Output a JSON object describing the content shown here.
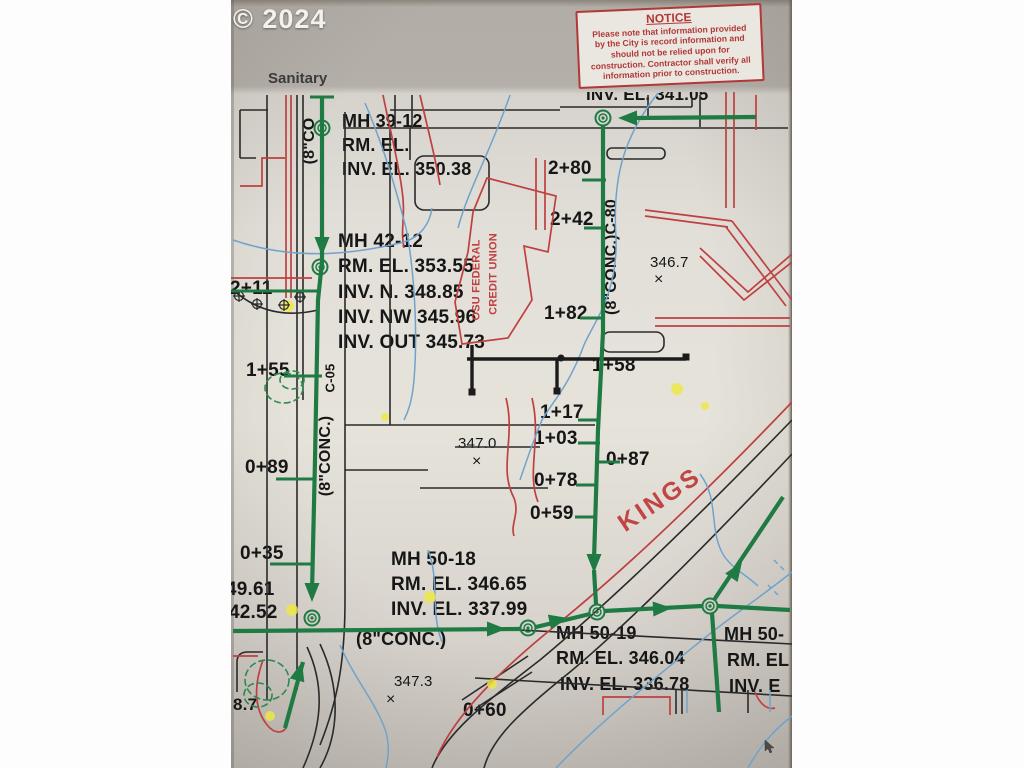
{
  "palette": {
    "sewer_green": "#1f7a43",
    "utility_red": "#bf4040",
    "contour_blue": "#6fa3cc",
    "ink_black": "#222222",
    "highlight_yellow": "#eee93f",
    "notice_red": "#b23737",
    "paper": "#ddd9d2"
  },
  "watermark": {
    "text": "© 2024"
  },
  "photo": {
    "band_label": "Sanitary"
  },
  "notice": {
    "title": "NOTICE",
    "lines": [
      "Please note that information provided",
      "by the City is record information and",
      "should not be relied upon for",
      "construction. Contractor shall verify all",
      "information prior to construction."
    ]
  },
  "map_labels": [
    {
      "name": "inv-el-341",
      "text": "INV. EL. 341.05",
      "x": 586,
      "y": 86,
      "fs": 17
    },
    {
      "name": "mh-39-12-line1",
      "text": "MH 39-12",
      "x": 342,
      "y": 112,
      "fs": 18
    },
    {
      "name": "mh-39-12-line2",
      "text": "RM. EL.",
      "x": 342,
      "y": 136,
      "fs": 18
    },
    {
      "name": "mh-39-12-line3",
      "text": "INV. EL. 350.38",
      "x": 342,
      "y": 160,
      "fs": 18
    },
    {
      "name": "station-2-80",
      "text": "2+80",
      "x": 548,
      "y": 159,
      "fs": 19
    },
    {
      "name": "station-2-42",
      "text": "2+42",
      "x": 550,
      "y": 210,
      "fs": 19
    },
    {
      "name": "pipe-label-c80",
      "text": "(8\"CONC.)C-80",
      "x": 612,
      "y": 257,
      "fs": 16,
      "rot": -90,
      "anchor": "c"
    },
    {
      "name": "spot-elev-346-7",
      "text": "346.7",
      "x": 650,
      "y": 255,
      "fs": 15,
      "w": 400
    },
    {
      "name": "spot-elev-346-7-x",
      "text": "×",
      "x": 654,
      "y": 272,
      "fs": 16,
      "w": 400
    },
    {
      "name": "mh-42-12-line1",
      "text": "MH 42-12",
      "x": 338,
      "y": 232,
      "fs": 19
    },
    {
      "name": "mh-42-12-line2",
      "text": "RM. EL. 353.55",
      "x": 338,
      "y": 257,
      "fs": 19
    },
    {
      "name": "mh-42-12-line3",
      "text": "INV. N. 348.85",
      "x": 338,
      "y": 283,
      "fs": 19
    },
    {
      "name": "mh-42-12-line4",
      "text": "INV. NW 345.96",
      "x": 338,
      "y": 308,
      "fs": 19
    },
    {
      "name": "mh-42-12-line5",
      "text": "INV. OUT 345.73",
      "x": 338,
      "y": 333,
      "fs": 19
    },
    {
      "name": "credit-union-line1",
      "text": "OSU FEDERAL",
      "x": 477,
      "y": 280,
      "fs": 11,
      "rot": -90,
      "anchor": "c",
      "color": "#bf4040"
    },
    {
      "name": "credit-union-line2",
      "text": "CREDIT UNION",
      "x": 494,
      "y": 274,
      "fs": 11,
      "rot": -90,
      "anchor": "c",
      "color": "#bf4040"
    },
    {
      "name": "station-2-11",
      "text": "2+11",
      "x": 230,
      "y": 279,
      "fs": 19
    },
    {
      "name": "station-1-82",
      "text": "1+82",
      "x": 544,
      "y": 304,
      "fs": 19
    },
    {
      "name": "station-1-55",
      "text": "1+55",
      "x": 246,
      "y": 361,
      "fs": 19
    },
    {
      "name": "station-1-58",
      "text": "1+58",
      "x": 592,
      "y": 356,
      "fs": 19
    },
    {
      "name": "pipe-label-8co",
      "text": "(8\"CO",
      "x": 310,
      "y": 141,
      "fs": 16,
      "rot": -90,
      "anchor": "c"
    },
    {
      "name": "pipe-label-c05",
      "text": "C-05",
      "x": 330,
      "y": 378,
      "fs": 13,
      "rot": -90,
      "anchor": "c"
    },
    {
      "name": "pipe-label-conc-left",
      "text": "(8\"CONC.)",
      "x": 326,
      "y": 456,
      "fs": 16,
      "rot": -90,
      "anchor": "c"
    },
    {
      "name": "spot-elev-347-0",
      "text": "347.0",
      "x": 458,
      "y": 436,
      "fs": 15,
      "w": 400
    },
    {
      "name": "spot-elev-347-0-x",
      "text": "×",
      "x": 472,
      "y": 454,
      "fs": 16,
      "w": 400
    },
    {
      "name": "station-1-17",
      "text": "1+17",
      "x": 540,
      "y": 403,
      "fs": 19
    },
    {
      "name": "station-1-03",
      "text": "1+03",
      "x": 534,
      "y": 429,
      "fs": 19
    },
    {
      "name": "station-0-87",
      "text": "0+87",
      "x": 606,
      "y": 450,
      "fs": 19
    },
    {
      "name": "station-0-78",
      "text": "0+78",
      "x": 534,
      "y": 471,
      "fs": 19
    },
    {
      "name": "station-0-59",
      "text": "0+59",
      "x": 530,
      "y": 504,
      "fs": 19
    },
    {
      "name": "street-name-kings",
      "text": "KINGS",
      "x": 660,
      "y": 500,
      "fs": 25,
      "rot": -34,
      "anchor": "c",
      "color": "#c24545",
      "ls": 3
    },
    {
      "name": "station-0-89",
      "text": "0+89",
      "x": 245,
      "y": 458,
      "fs": 19
    },
    {
      "name": "station-0-35",
      "text": "0+35",
      "x": 240,
      "y": 544,
      "fs": 19
    },
    {
      "name": "elev-49-61",
      "text": "49.61",
      "x": 226,
      "y": 580,
      "fs": 19
    },
    {
      "name": "elev-42-52",
      "text": "42.52",
      "x": 229,
      "y": 603,
      "fs": 19
    },
    {
      "name": "mh-50-18-line1",
      "text": "MH 50-18",
      "x": 391,
      "y": 550,
      "fs": 19
    },
    {
      "name": "mh-50-18-line2",
      "text": "RM. EL. 346.65",
      "x": 391,
      "y": 575,
      "fs": 19
    },
    {
      "name": "mh-50-18-line3",
      "text": "INV. EL. 337.99",
      "x": 391,
      "y": 600,
      "fs": 19
    },
    {
      "name": "pipe-label-conc-bottom",
      "text": "(8\"CONC.)",
      "x": 356,
      "y": 630,
      "fs": 18
    },
    {
      "name": "mh-50-19-line1",
      "text": "MH 50-19",
      "x": 556,
      "y": 624,
      "fs": 18
    },
    {
      "name": "mh-50-19-line2",
      "text": "RM. EL. 346.04",
      "x": 556,
      "y": 649,
      "fs": 18
    },
    {
      "name": "mh-50-19-line3",
      "text": "INV. EL. 336.78",
      "x": 560,
      "y": 675,
      "fs": 18
    },
    {
      "name": "mh-50-x-line1",
      "text": "MH 50-",
      "x": 724,
      "y": 625,
      "fs": 18
    },
    {
      "name": "mh-50-x-line2",
      "text": "RM. EL",
      "x": 727,
      "y": 651,
      "fs": 18
    },
    {
      "name": "mh-50-x-line3",
      "text": "INV. E",
      "x": 729,
      "y": 677,
      "fs": 18
    },
    {
      "name": "spot-elev-347-3",
      "text": "347.3",
      "x": 394,
      "y": 674,
      "fs": 15,
      "w": 400
    },
    {
      "name": "spot-elev-347-3-x",
      "text": "×",
      "x": 386,
      "y": 692,
      "fs": 16,
      "w": 400
    },
    {
      "name": "station-0-60",
      "text": "0+60",
      "x": 463,
      "y": 701,
      "fs": 19
    },
    {
      "name": "elev-8-7",
      "text": "8.7",
      "x": 233,
      "y": 696,
      "fs": 17
    }
  ]
}
